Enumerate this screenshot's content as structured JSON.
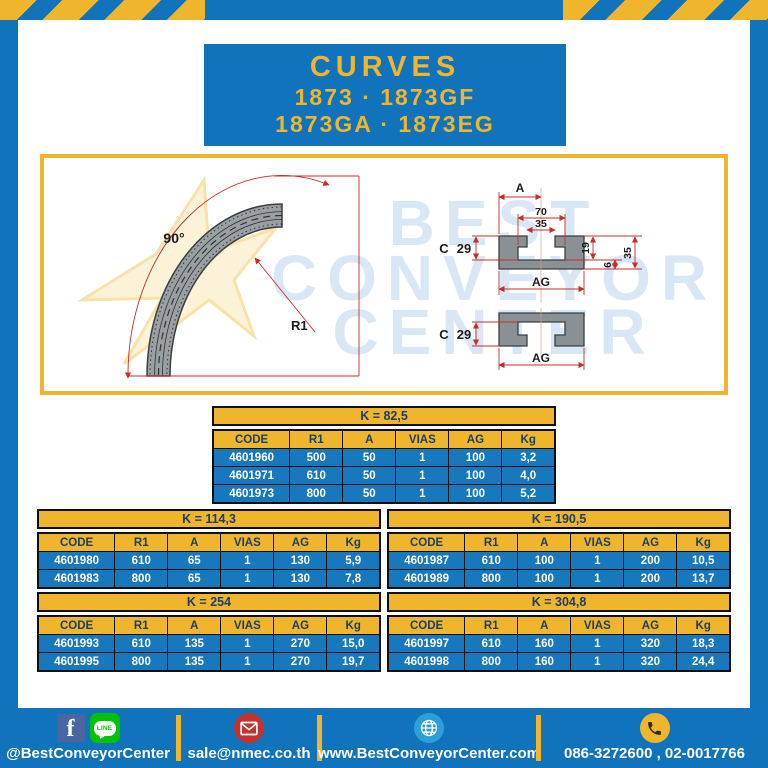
{
  "header": {
    "title": "CURVES",
    "models_line1": "1873 · 1873GF",
    "models_line2": "1873GA · 1873EG"
  },
  "drawing": {
    "angle_label": "90°",
    "radius_label": "R1",
    "dim_a": "A",
    "dim_70": "70",
    "dim_35_top": "35",
    "dim_c": "C",
    "dim_29": "29",
    "dim_19": "19",
    "dim_6": "6",
    "dim_35_right": "35",
    "dim_ag": "AG",
    "watermark": {
      "line1": "BEST",
      "line2": "CONVEYOR",
      "line3": "CENTER"
    }
  },
  "table_headers": [
    "CODE",
    "R1",
    "A",
    "VIAS",
    "AG",
    "Kg"
  ],
  "tables": [
    {
      "title": "K = 82,5",
      "rows": [
        [
          "4601960",
          "500",
          "50",
          "1",
          "100",
          "3,2"
        ],
        [
          "4601971",
          "610",
          "50",
          "1",
          "100",
          "4,0"
        ],
        [
          "4601973",
          "800",
          "50",
          "1",
          "100",
          "5,2"
        ]
      ]
    },
    {
      "title": "K = 114,3",
      "rows": [
        [
          "4601980",
          "610",
          "65",
          "1",
          "130",
          "5,9"
        ],
        [
          "4601983",
          "800",
          "65",
          "1",
          "130",
          "7,8"
        ]
      ]
    },
    {
      "title": "K = 190,5",
      "rows": [
        [
          "4601987",
          "610",
          "100",
          "1",
          "200",
          "10,5"
        ],
        [
          "4601989",
          "800",
          "100",
          "1",
          "200",
          "13,7"
        ]
      ]
    },
    {
      "title": "K = 254",
      "rows": [
        [
          "4601993",
          "610",
          "135",
          "1",
          "270",
          "15,0"
        ],
        [
          "4601995",
          "800",
          "135",
          "1",
          "270",
          "19,7"
        ]
      ]
    },
    {
      "title": "K = 304,8",
      "rows": [
        [
          "4601997",
          "610",
          "160",
          "1",
          "320",
          "18,3"
        ],
        [
          "4601998",
          "800",
          "160",
          "1",
          "320",
          "24,4"
        ]
      ]
    }
  ],
  "footer": {
    "facebook_handle": "@BestConveyorCenter",
    "line_badge": "LINE",
    "email": "sale@nmec.co.th",
    "website": "www.BestConveyorCenter.com",
    "phones": "086-3272600 , 02-0017766"
  },
  "colors": {
    "brand_blue": "#1173bb",
    "brand_yellow": "#efb52c",
    "table_cell_blue": "#1778be",
    "table_text_dark": "#1c3f66",
    "dimension_red": "#c42e2e",
    "facebook_blue": "#4a66a0",
    "line_green": "#00c300",
    "envelope_red": "#c4322e",
    "globe_blue": "#2ba0d8"
  }
}
